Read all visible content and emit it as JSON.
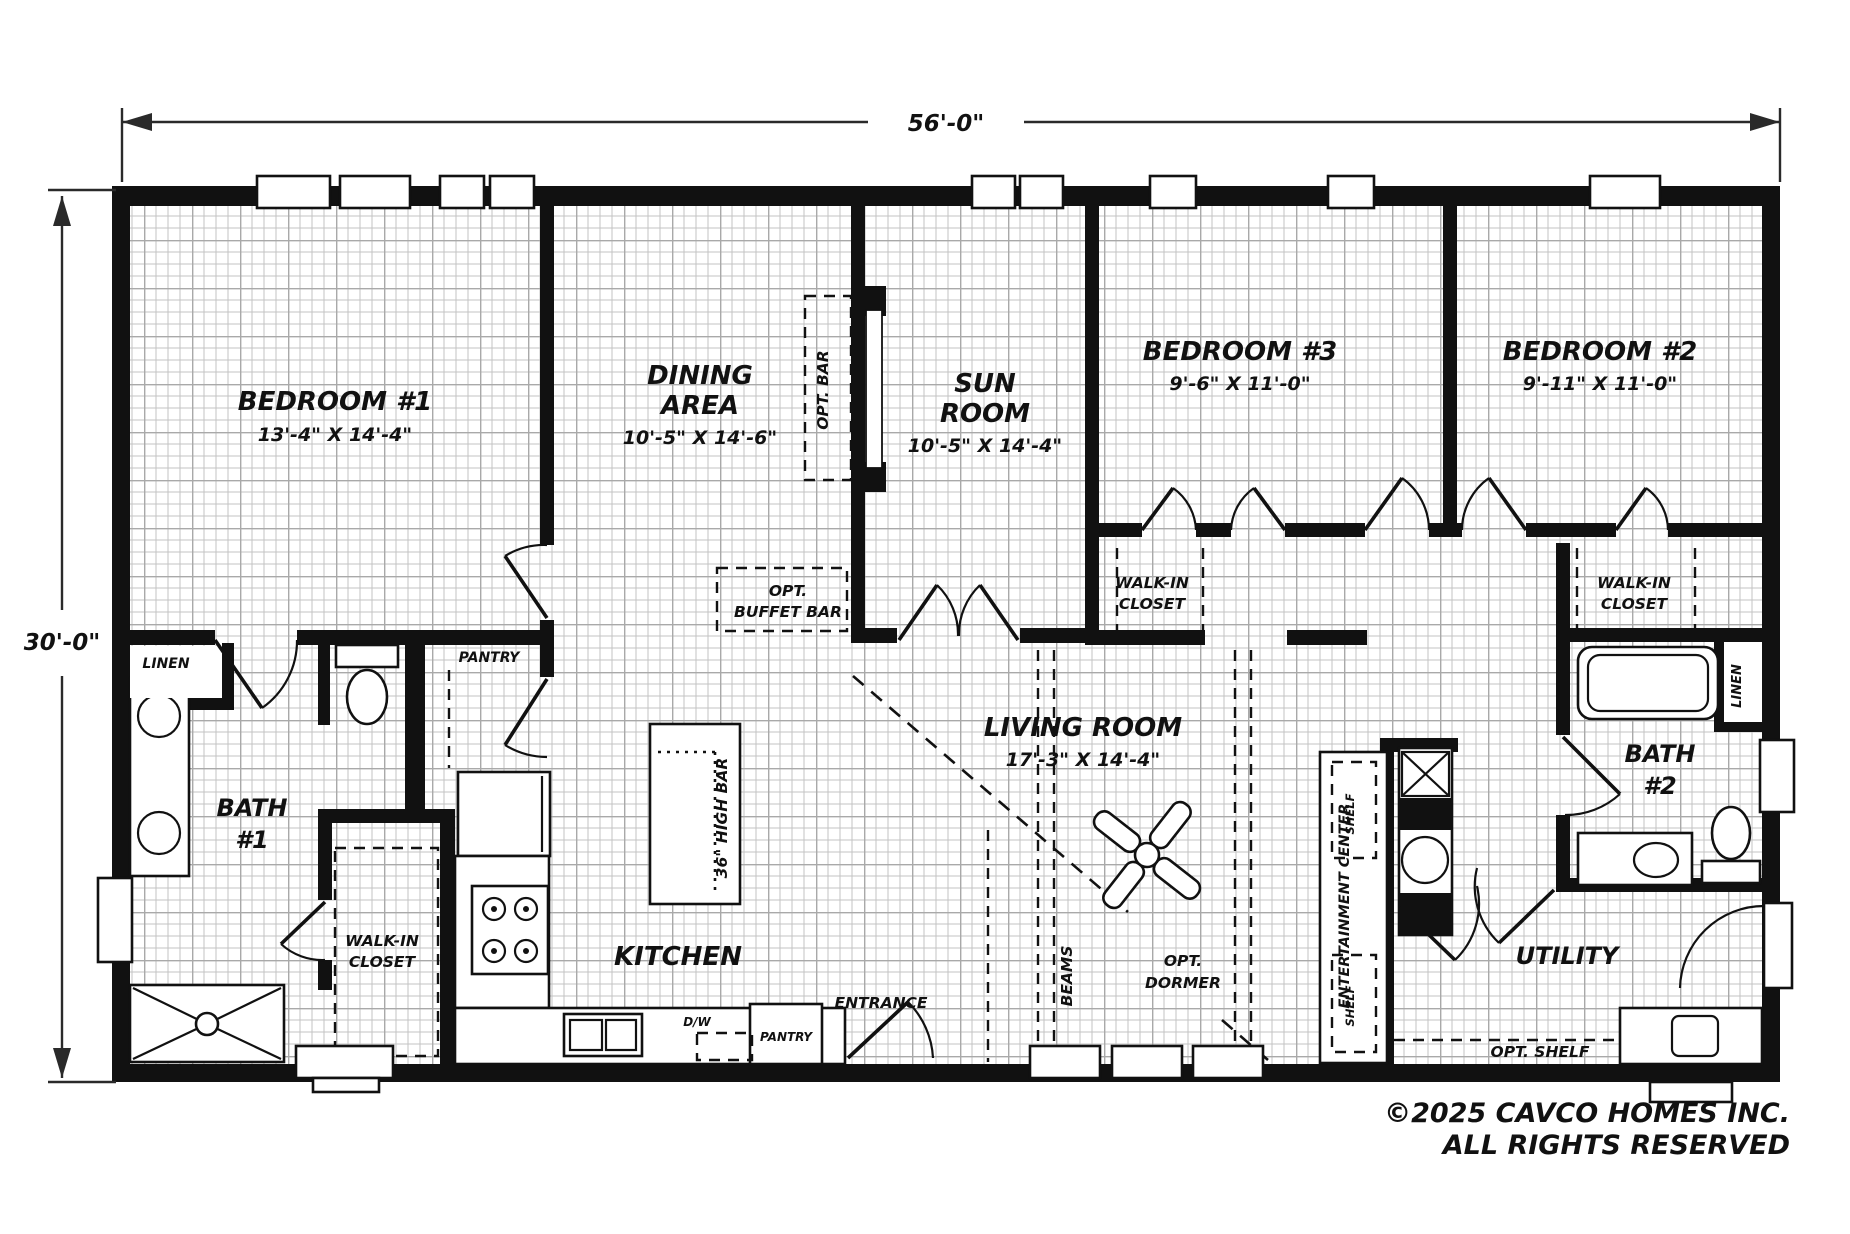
{
  "dimensions": {
    "top": "56'-0\"",
    "left": "30'-0\""
  },
  "rooms": {
    "bedroom1": {
      "name": "BEDROOM #1",
      "size": "13'-4\" X 14'-4\""
    },
    "dining": {
      "name1": "DINING",
      "name2": "AREA",
      "size": "10'-5\" X 14'-6\""
    },
    "sunroom": {
      "name1": "SUN",
      "name2": "ROOM",
      "size": "10'-5\" X 14'-4\""
    },
    "bedroom3": {
      "name": "BEDROOM #3",
      "size": "9'-6\" X 11'-0\""
    },
    "bedroom2": {
      "name": "BEDROOM #2",
      "size": "9'-11\" X 11'-0\""
    },
    "living": {
      "name": "LIVING ROOM",
      "size": "17'-3\" X 14'-4\""
    },
    "kitchen": {
      "name": "KITCHEN"
    },
    "bath1": {
      "name1": "BATH",
      "name2": "#1"
    },
    "bath2": {
      "name1": "BATH",
      "name2": "#2"
    },
    "utility": {
      "name": "UTILITY"
    }
  },
  "features": {
    "walkin1": "WALK-IN",
    "walkin2": "CLOSET",
    "linen": "LINEN",
    "pantry": "PANTRY",
    "opt_bar": "OPT. BAR",
    "opt_buffet1": "OPT.",
    "opt_buffet2": "BUFFET BAR",
    "high_bar": "36\" HIGH BAR",
    "beams": "BEAMS",
    "opt_dormer1": "OPT.",
    "opt_dormer2": "DORMER",
    "entrance": "ENTRANCE",
    "ent_center": "ENTERTAINMENT CENTER",
    "shelf": "SHELF",
    "opt_shelf": "OPT. SHELF",
    "dw": "D/W"
  },
  "copyright": {
    "line1": "©2025 CAVCO HOMES INC.",
    "line2": "ALL RIGHTS RESERVED"
  },
  "colors": {
    "wall": "#111111",
    "grid_minor": "#c3c3c3",
    "grid_major": "#a9a9a9",
    "background": "#ffffff"
  }
}
